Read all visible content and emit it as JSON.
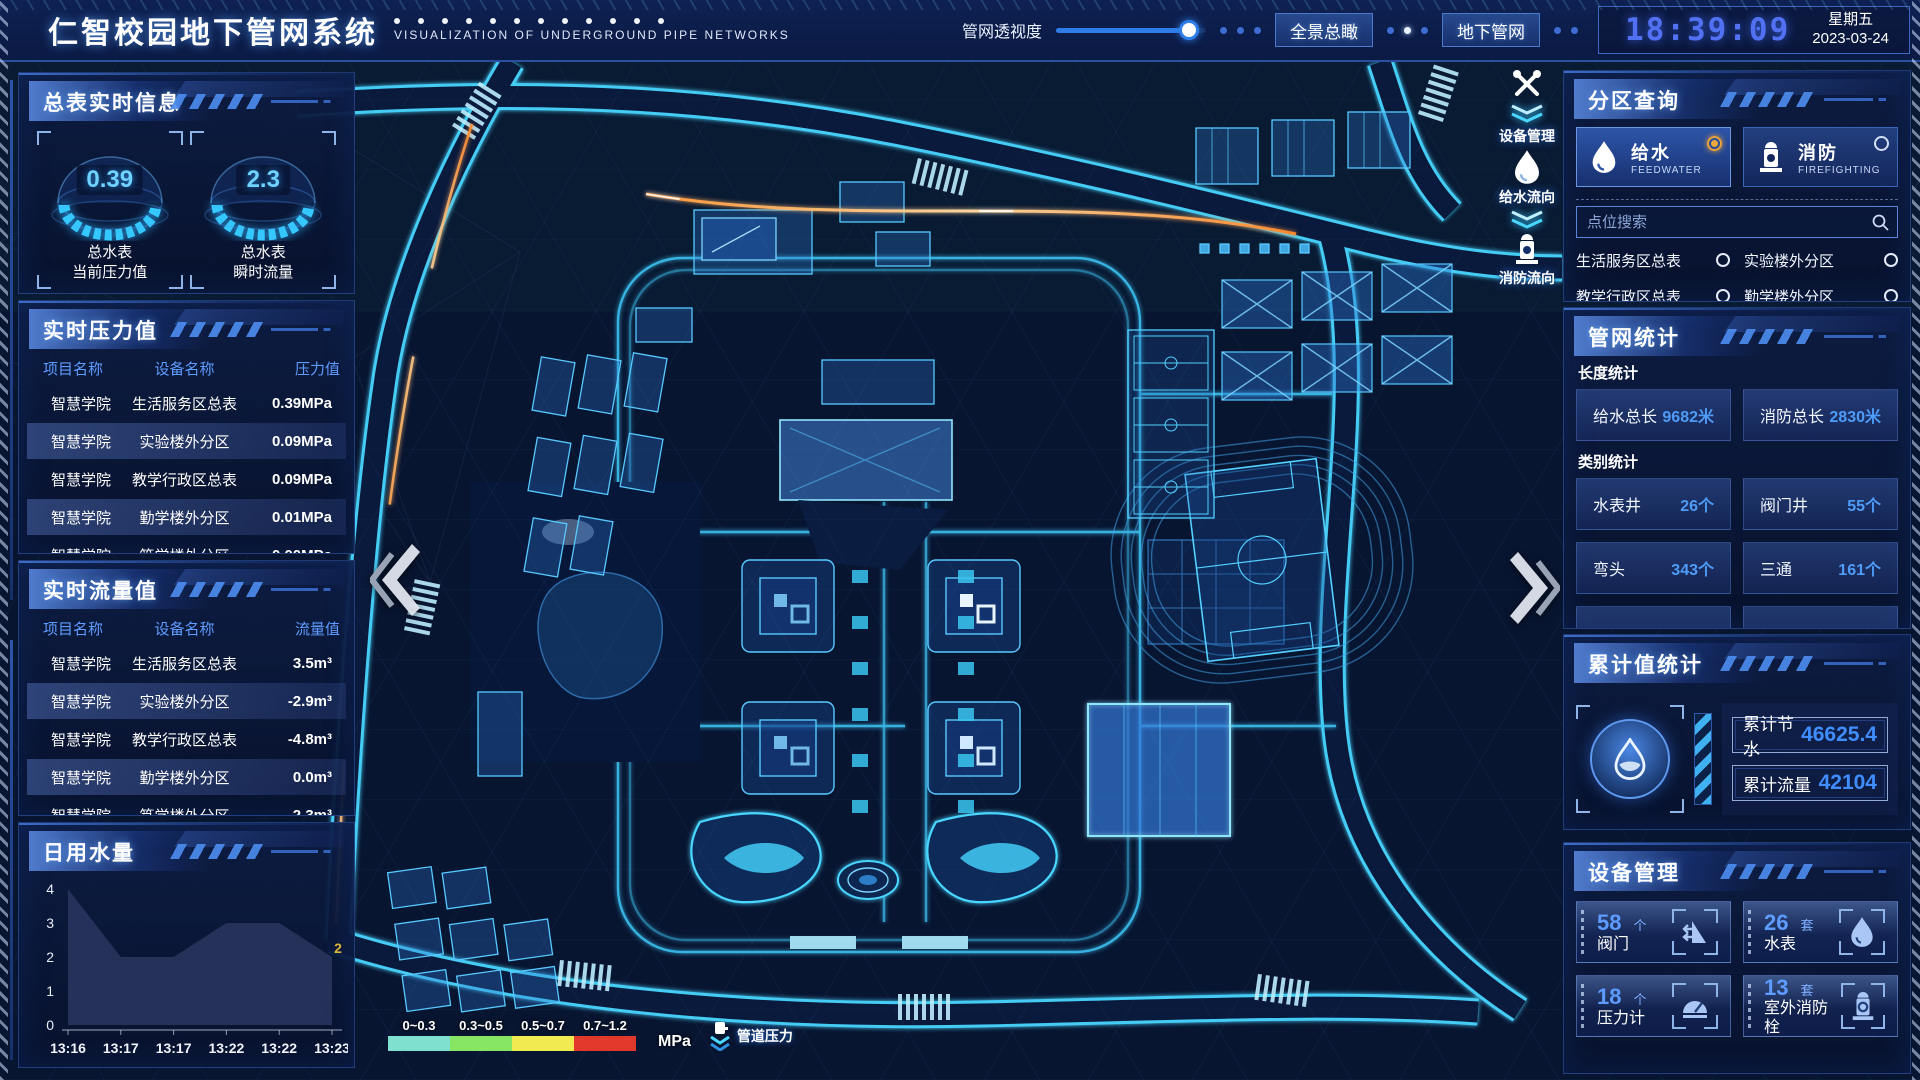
{
  "header": {
    "title": "仁智校园地下管网系统",
    "subtitle": "VISUALIZATION OF UNDERGROUND PIPE NETWORKS",
    "transparency_label": "管网透视度",
    "btn_overview": "全景总瞰",
    "btn_underground": "地下管网",
    "time": "18:39:09",
    "weekday": "星期五",
    "date": "2023-03-24"
  },
  "left": {
    "meter_panel": {
      "title": "总表实时信息",
      "gauges": [
        {
          "value": "0.39",
          "label1": "总水表",
          "label2": "当前压力值"
        },
        {
          "value": "2.3",
          "label1": "总水表",
          "label2": "瞬时流量"
        }
      ]
    },
    "pressure_panel": {
      "title": "实时压力值",
      "headers": [
        "项目名称",
        "设备名称",
        "压力值"
      ],
      "rows": [
        {
          "project": "智慧学院",
          "device": "生活服务区总表",
          "value": "0.39MPa"
        },
        {
          "project": "智慧学院",
          "device": "实验楼外分区",
          "value": "0.09MPa"
        },
        {
          "project": "智慧学院",
          "device": "教学行政区总表",
          "value": "0.09MPa"
        },
        {
          "project": "智慧学院",
          "device": "勤学楼外分区",
          "value": "0.01MPa"
        },
        {
          "project": "智慧学院",
          "device": "笃学楼外分区",
          "value": "0.00MPa"
        }
      ]
    },
    "flow_panel": {
      "title": "实时流量值",
      "headers": [
        "项目名称",
        "设备名称",
        "流量值"
      ],
      "rows": [
        {
          "project": "智慧学院",
          "device": "生活服务区总表",
          "value": "3.5m³"
        },
        {
          "project": "智慧学院",
          "device": "实验楼外分区",
          "value": "-2.9m³"
        },
        {
          "project": "智慧学院",
          "device": "教学行政区总表",
          "value": "-4.8m³"
        },
        {
          "project": "智慧学院",
          "device": "勤学楼外分区",
          "value": "0.0m³"
        },
        {
          "project": "智慧学院",
          "device": "笃学楼外分区",
          "value": "-2.3m³"
        }
      ]
    },
    "daily_panel": {
      "title": "日用水量"
    }
  },
  "chart_data": {
    "type": "area",
    "title": "日用水量",
    "x": [
      "13:16",
      "13:17",
      "13:17",
      "13:22",
      "13:22",
      "13:23"
    ],
    "values": [
      4,
      2,
      2,
      3,
      3,
      2
    ],
    "ylim": [
      0,
      4
    ],
    "yticks": [
      0,
      1,
      2,
      3,
      4
    ],
    "area_color": "#27335c",
    "annotation": {
      "text": "2",
      "color": "#d9b83c"
    }
  },
  "right": {
    "zone_panel": {
      "title": "分区查询",
      "feedwater": {
        "label": "给水",
        "sub": "FEEDWATER"
      },
      "firefighting": {
        "label": "消防",
        "sub": "FIREFIGHTING"
      },
      "search_placeholder": "点位搜索",
      "items": [
        "生活服务区总表",
        "实验楼外分区",
        "教学行政区总表",
        "勤学楼外分区",
        "砺学楼外分区",
        "宿舍区泵房"
      ]
    },
    "network_panel": {
      "title": "管网统计",
      "length_title": "长度统计",
      "length_stats": [
        {
          "label": "给水总长",
          "value": "9682米"
        },
        {
          "label": "消防总长",
          "value": "2830米"
        }
      ],
      "category_title": "类别统计",
      "category_stats": [
        {
          "label": "水表井",
          "value": "26个"
        },
        {
          "label": "阀门井",
          "value": "55个"
        },
        {
          "label": "弯头",
          "value": "343个"
        },
        {
          "label": "三通",
          "value": "161个"
        }
      ]
    },
    "cumulative_panel": {
      "title": "累计值统计",
      "stats": [
        {
          "label": "累计节水",
          "value": "46625.4"
        },
        {
          "label": "累计流量",
          "value": "42104"
        }
      ]
    },
    "device_panel": {
      "title": "设备管理",
      "cards": [
        {
          "count": "58",
          "unit": "个",
          "label": "阀门"
        },
        {
          "count": "26",
          "unit": "套",
          "label": "水表"
        },
        {
          "count": "18",
          "unit": "个",
          "label": "压力计"
        },
        {
          "count": "13",
          "unit": "套",
          "label": "室外消防栓"
        }
      ]
    }
  },
  "map": {
    "float_buttons": [
      {
        "label": "设备管理"
      },
      {
        "label": "给水流向"
      },
      {
        "label": "消防流向"
      }
    ],
    "legend": {
      "ranges": [
        "0~0.3",
        "0.3~0.5",
        "0.5~0.7",
        "0.7~1.2"
      ],
      "colors": [
        "#7fe0cf",
        "#86e563",
        "#f2ea51",
        "#e0392b"
      ],
      "unit": "MPa",
      "label": "管道压力"
    }
  }
}
